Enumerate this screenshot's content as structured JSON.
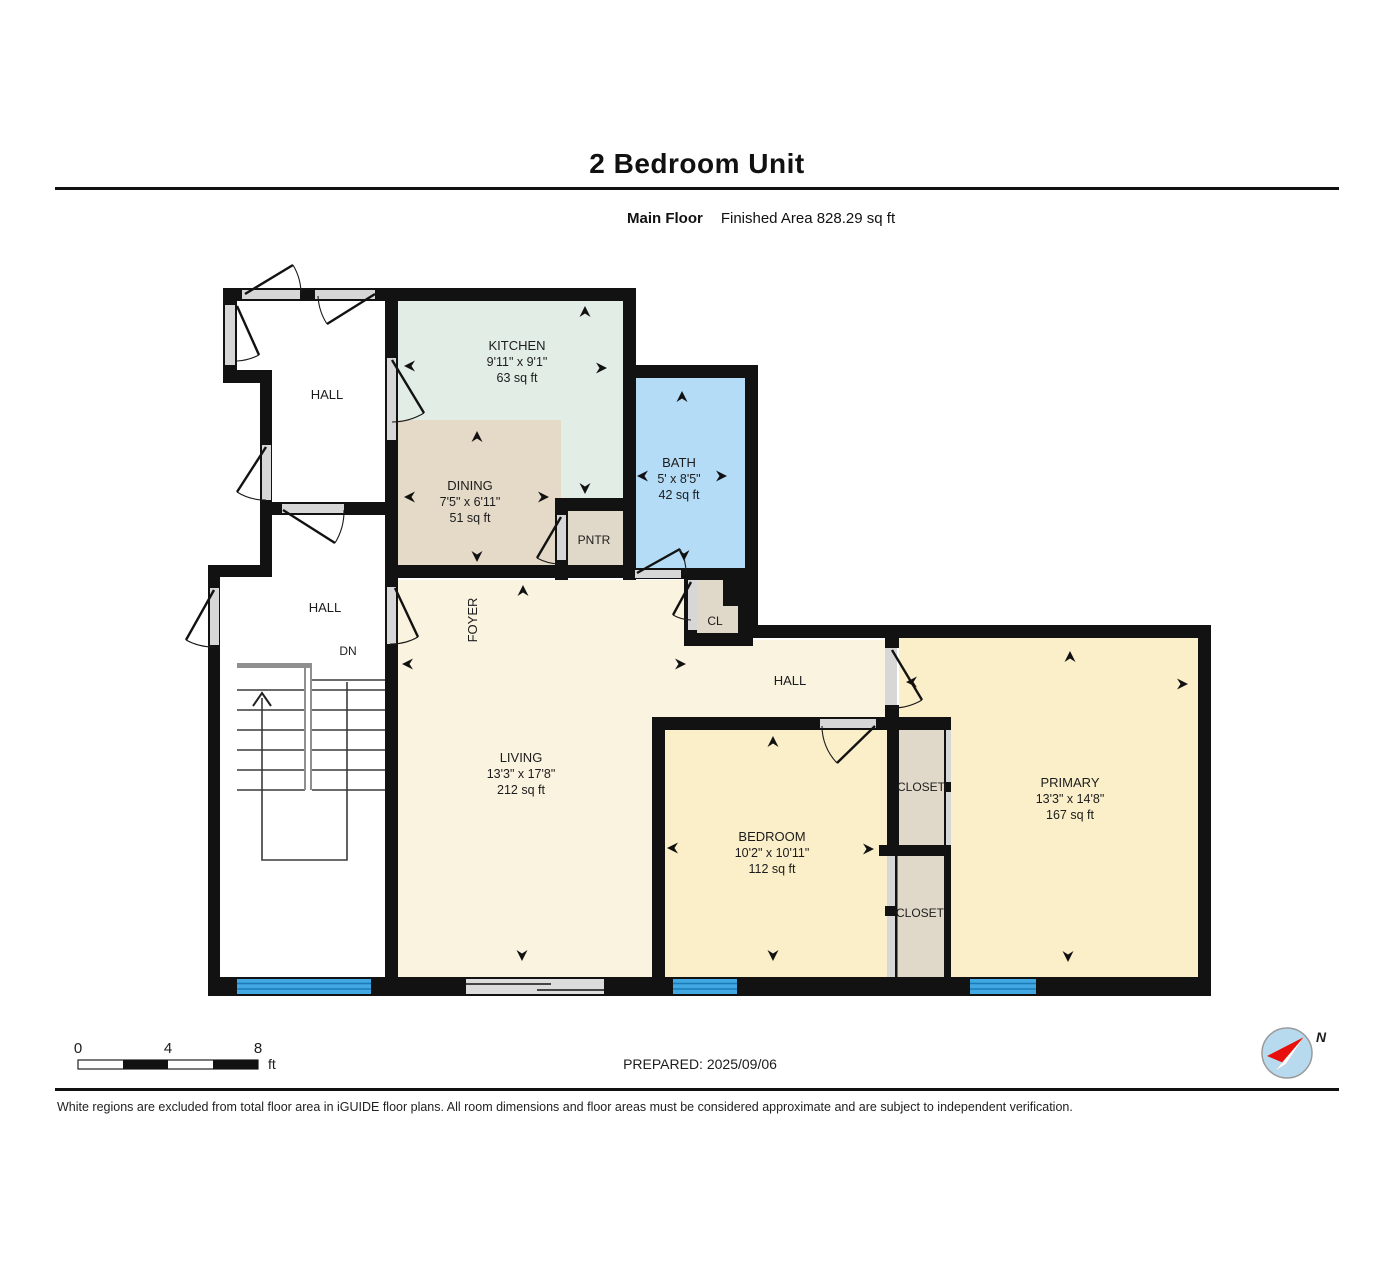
{
  "page": {
    "title": "2 Bedroom Unit",
    "floor_label": "Main Floor",
    "area_label": "Finished Area 828.29 sq ft",
    "prepared": "PREPARED: 2025/09/06",
    "disclaimer": "White regions are excluded from total floor area in iGUIDE floor plans. All room dimensions and floor areas must be considered approximate and are subject to independent verification."
  },
  "rooms": {
    "kitchen": {
      "name": "KITCHEN",
      "dims": "9'11\" x 9'1\"",
      "area": "63 sq ft"
    },
    "dining": {
      "name": "DINING",
      "dims": "7'5\" x 6'11\"",
      "area": "51 sq ft"
    },
    "bath": {
      "name": "BATH",
      "dims": "5' x 8'5\"",
      "area": "42 sq ft"
    },
    "living": {
      "name": "LIVING",
      "dims": "13'3\" x 17'8\"",
      "area": "212 sq ft"
    },
    "bedroom": {
      "name": "BEDROOM",
      "dims": "10'2\" x 10'11\"",
      "area": "112 sq ft"
    },
    "primary": {
      "name": "PRIMARY",
      "dims": "13'3\" x 14'8\"",
      "area": "167 sq ft"
    }
  },
  "labels": {
    "hall_upper": "HALL",
    "hall_lower": "HALL",
    "hall_inner": "HALL",
    "down": "DN",
    "foyer": "FOYER",
    "pantry": "PNTR",
    "closet_small": "CL",
    "closet_upper": "CLOSET",
    "closet_lower": "CLOSET"
  },
  "scale_bar": {
    "tick0": "0",
    "tick1": "4",
    "tick2": "8",
    "unit": "ft"
  },
  "compass": {
    "north": "N"
  },
  "colors": {
    "wall": "#121212",
    "kitchen": "#E2EEE5",
    "dining": "#E4DAC7",
    "bath": "#B4DCF6",
    "living": "#FAF3DF",
    "bedroom": "#FBEFC9",
    "closet": "#E0D8C9",
    "hall_white": "#FFFFFF",
    "window": "#41A8E1"
  }
}
